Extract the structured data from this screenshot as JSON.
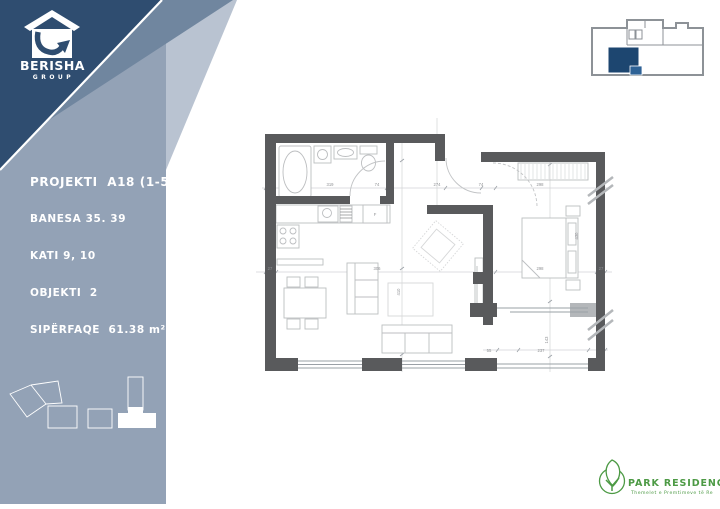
{
  "brand": {
    "name": "BERISHA",
    "subtitle": "GROUP"
  },
  "project_info": {
    "lines": [
      "PROJEKTI  A18 (1-5)",
      "BANESA 35. 39",
      "KATI 9, 10",
      "OBJEKTI  2",
      "SIPËRFAQE  61.38 m²"
    ]
  },
  "floor_plan": {
    "dimension_labels": [
      {
        "t": "319",
        "x": 330,
        "y": 186
      },
      {
        "t": "74",
        "x": 377,
        "y": 186
      },
      {
        "t": "274",
        "x": 437,
        "y": 186
      },
      {
        "t": "74",
        "x": 481,
        "y": 186
      },
      {
        "t": "298",
        "x": 540,
        "y": 186
      },
      {
        "t": "27",
        "x": 270,
        "y": 270
      },
      {
        "t": "306",
        "x": 377,
        "y": 270
      },
      {
        "t": "298",
        "x": 540,
        "y": 270
      },
      {
        "t": "27",
        "x": 601,
        "y": 270
      },
      {
        "t": "410",
        "x": 400,
        "y": 292,
        "r": -90
      },
      {
        "t": "430",
        "x": 578,
        "y": 236,
        "r": -90
      },
      {
        "t": "143",
        "x": 548,
        "y": 340,
        "r": -90
      },
      {
        "t": "55",
        "x": 489,
        "y": 352
      },
      {
        "t": "237",
        "x": 541,
        "y": 352
      },
      {
        "t": "F",
        "x": 375,
        "y": 216
      }
    ]
  },
  "key_plan": {
    "highlight_color": "#1d4670"
  },
  "footer_logo": {
    "name": "PARK RESIDENCE",
    "tagline": "Themelet e Premtimeve të Re"
  },
  "colors": {
    "navy": "#2f4d70",
    "mid_band": "#70869f",
    "light_band": "#b9c3d1",
    "panel": "#93a2b6",
    "wall": "#595a5c",
    "green": "#4d9a45",
    "keyplan_gray": "#8d9297"
  }
}
